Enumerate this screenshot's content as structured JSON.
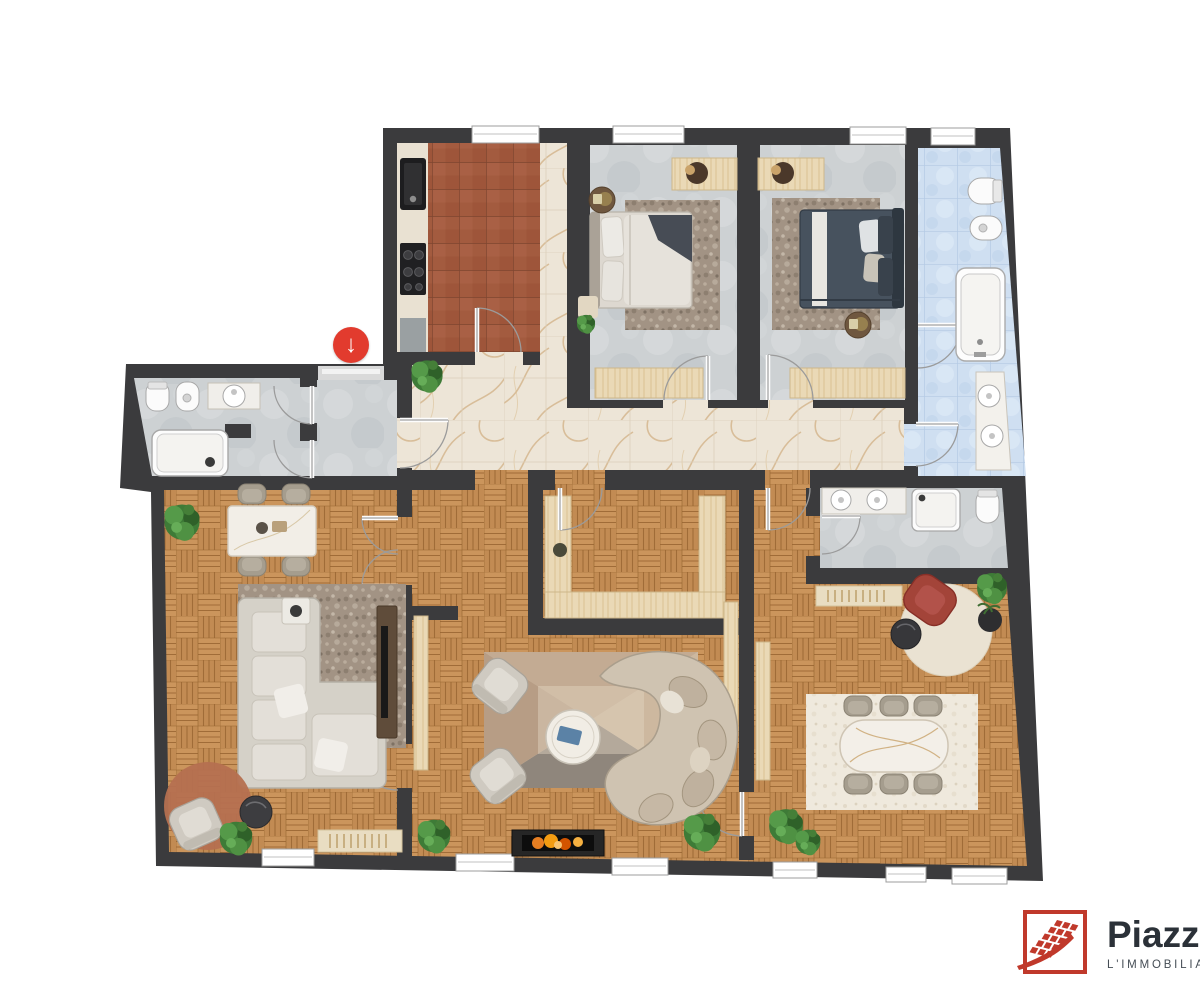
{
  "canvas": {
    "width": 1200,
    "height": 1000,
    "background": "#ffffff"
  },
  "branding": {
    "name": "Piazza",
    "tagline": "L'IMMOBILIARE",
    "accent_color": "#c0392b",
    "name_color": "#2b3138",
    "tagline_color": "#454d55"
  },
  "entrance_marker": {
    "icon": "arrow-down-icon",
    "symbol": "↓",
    "background_color": "#e23b2e",
    "symbol_color": "#ffffff"
  },
  "floor_plan": {
    "type": "apartment-floor-plan",
    "rooms": [
      "kitchen",
      "bedroom-1",
      "bedroom-2",
      "bathroom-main",
      "corridor",
      "entry-hall",
      "bathroom-entry",
      "walk-in-closet",
      "living-room",
      "lounge",
      "bathroom-second",
      "dining-room"
    ],
    "palette": {
      "walls": "#3b3b3d",
      "parquet": "#c28b53",
      "marble": "#ede5d7",
      "terracotta_tile": "#a35b3f",
      "concrete": "#cdd1d3",
      "blue_tile": "#cfdff1",
      "light_wood": "#ead9b6",
      "fixture_white": "#fbfbfb",
      "fire": "#e67e22",
      "accent_chair_red": "#a34439"
    }
  }
}
